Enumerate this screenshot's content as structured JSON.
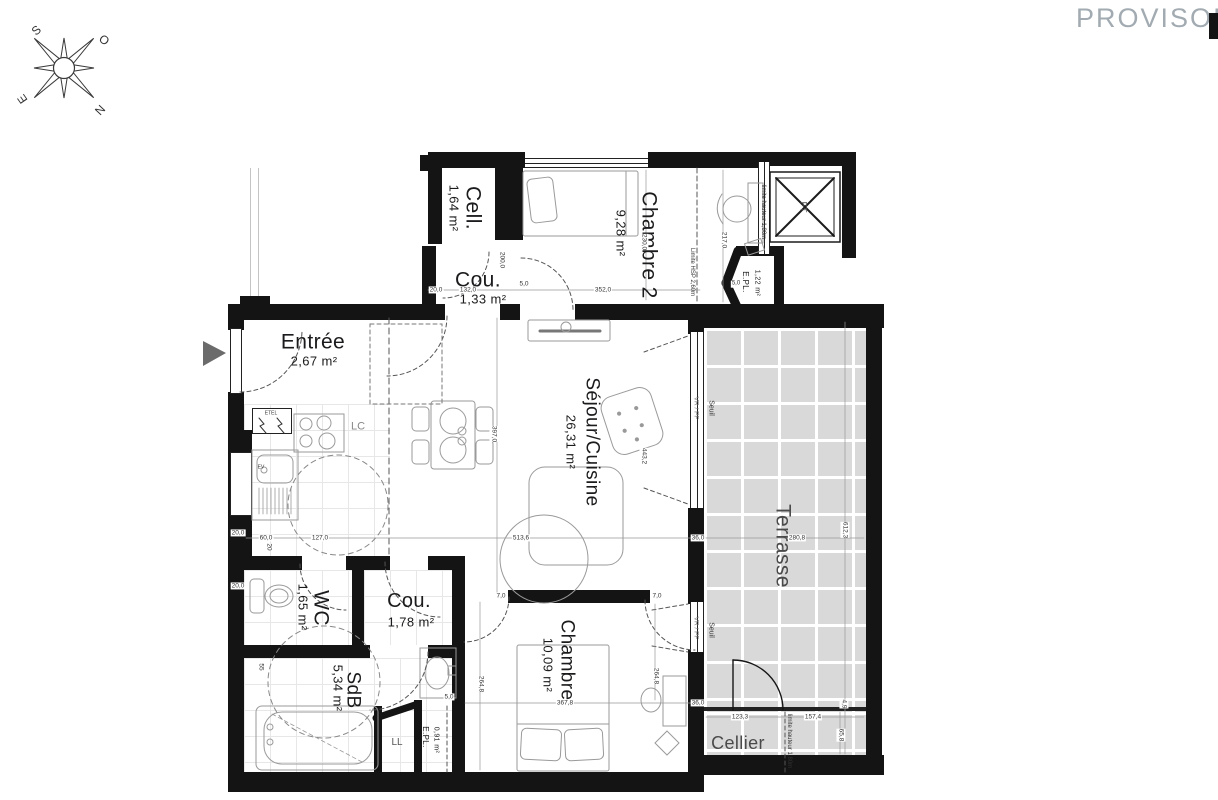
{
  "stamp": "PROVISOIRE",
  "compass": {
    "s": "S",
    "o": "O",
    "e": "E",
    "n": "N"
  },
  "rooms": {
    "cell": {
      "name": "Cell.",
      "area": "1,64 m²"
    },
    "cou_haut": {
      "name": "Cou.",
      "area": "1,33 m²"
    },
    "chambre2": {
      "name": "Chambre 2",
      "area": "9,28 m²"
    },
    "epl_haut": {
      "name": "E.PL.",
      "area": "1,22 m²"
    },
    "entree": {
      "name": "Entrée",
      "area": "2,67 m²"
    },
    "sejour": {
      "name": "Séjour/Cuisine",
      "area": "26,31 m²"
    },
    "terrasse": {
      "name": "Terrasse"
    },
    "wc": {
      "name": "WC",
      "area": "1,65 m²"
    },
    "cou_bas": {
      "name": "Cou.",
      "area": "1,78 m²"
    },
    "sdb": {
      "name": "SdB",
      "area": "5,34 m²"
    },
    "chambre": {
      "name": "Chambre",
      "area": "10,09 m²"
    },
    "cellier": {
      "name": "Cellier"
    },
    "epl_bas": {
      "name": "E.PL.",
      "area": "0,91 m²"
    }
  },
  "annotations": {
    "ft": "FT",
    "lc": "LC",
    "ll": "LL",
    "etel": "ETEL",
    "ev": "EV",
    "seuil": "Seuil",
    "vrpf": "VR / PF",
    "limite_hsp": "Limite HSP 2,60m",
    "limite_hauteur": "limite hauteur 1,80m"
  },
  "dims": {
    "d132": "132,0",
    "d5": "5,0",
    "d352": "352,0",
    "d200": "200,0",
    "d230": "230,0",
    "d217": "217,0",
    "d397": "397,0",
    "d4432": "443,2",
    "d5136": "513,6",
    "d127": "127,0",
    "d60": "60,0",
    "w20": "20,0",
    "d20": "20",
    "d36": "36,0",
    "d2808": "280,8",
    "d6123": "612,3",
    "d7": "7,0",
    "d2648": "264,8",
    "d3678": "367,8",
    "d55": "55",
    "d1233": "123,3",
    "d1574": "157,4",
    "d658": "65,8",
    "d49": "4,9"
  },
  "colors": {
    "wall": "#141414",
    "terrace_fill": "#d9d9d9",
    "stamp_gray": "#a2abb1"
  }
}
